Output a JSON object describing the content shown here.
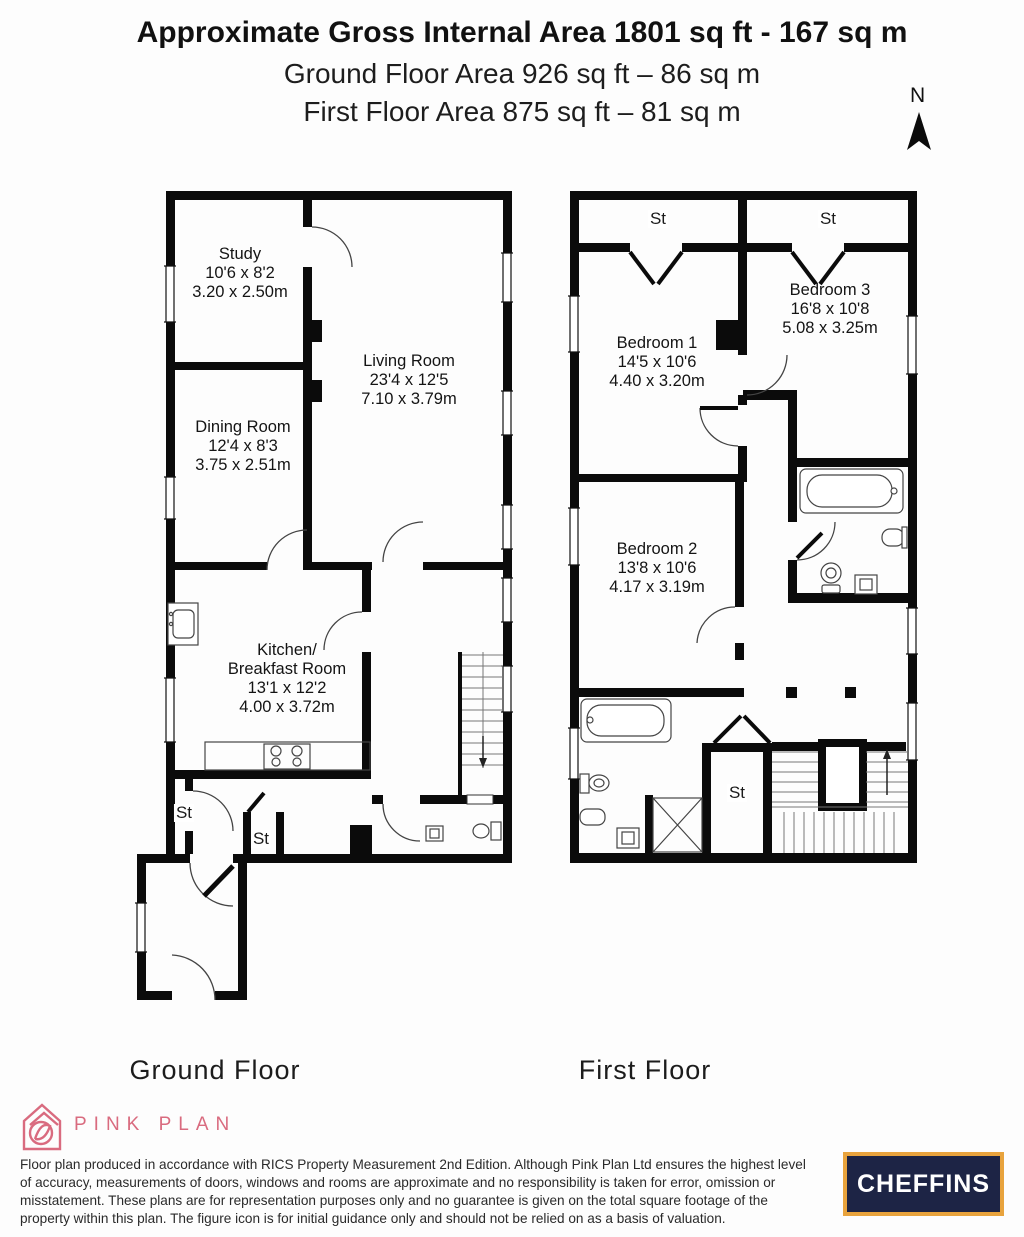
{
  "header": {
    "title": "Approximate Gross Internal Area 1801 sq ft - 167 sq m",
    "ground_line": "Ground Floor Area 926 sq ft – 86 sq m",
    "first_line": "First Floor Area 875 sq ft – 81 sq m",
    "compass_n": "N"
  },
  "ground_floor": {
    "label": "Ground Floor",
    "rooms": {
      "study": {
        "name": "Study",
        "imperial": "10'6 x 8'2",
        "metric": "3.20 x 2.50m"
      },
      "living_room": {
        "name": "Living Room",
        "imperial": "23'4 x 12'5",
        "metric": "7.10 x 3.79m"
      },
      "dining_room": {
        "name": "Dining Room",
        "imperial": "12'4 x 8'3",
        "metric": "3.75 x 2.51m"
      },
      "kitchen": {
        "name_line1": "Kitchen/",
        "name_line2": "Breakfast Room",
        "imperial": "13'1 x 12'2",
        "metric": "4.00 x 3.72m"
      },
      "store1": {
        "name": "St"
      },
      "store2": {
        "name": "St"
      }
    }
  },
  "first_floor": {
    "label": "First Floor",
    "rooms": {
      "bedroom1": {
        "name": "Bedroom 1",
        "imperial": "14'5 x 10'6",
        "metric": "4.40 x 3.20m"
      },
      "bedroom2": {
        "name": "Bedroom 2",
        "imperial": "13'8 x 10'6",
        "metric": "4.17 x 3.19m"
      },
      "bedroom3": {
        "name": "Bedroom 3",
        "imperial": "16'8 x 10'8",
        "metric": "5.08 x 3.25m"
      },
      "store_left": {
        "name": "St"
      },
      "store_right": {
        "name": "St"
      },
      "store_landing": {
        "name": "St"
      }
    }
  },
  "footer": {
    "producer_name": "PINK PLAN",
    "disclaimer": "Floor plan produced in accordance with RICS Property Measurement 2nd Edition. Although Pink Plan Ltd ensures the highest level of accuracy, measurements of doors, windows and rooms are approximate and no responsibility is taken for error, omission or misstatement. These plans are for representation purposes only and no guarantee is given on the total square footage of the property within this plan. The figure icon is for initial guidance only and should not be relied on as a basis of valuation.",
    "agent_logo": "CHEFFINS"
  },
  "colors": {
    "brand_pink": "#d96b7f",
    "agent_navy": "#1d2445",
    "agent_gold": "#e8a33d",
    "wall_black": "#0b0b0b"
  }
}
